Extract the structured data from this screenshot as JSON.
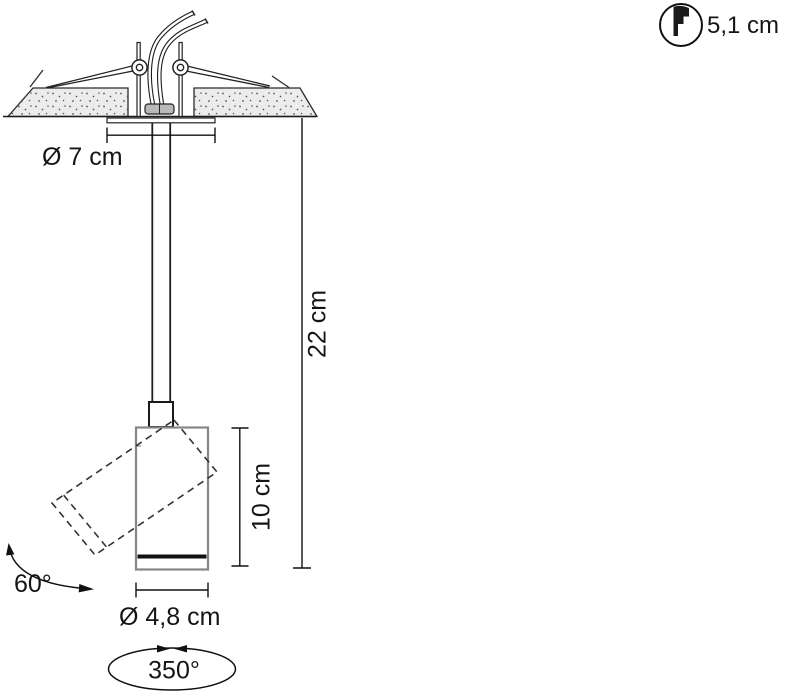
{
  "diagram": {
    "subject": "Recessed ceiling spotlight - installation drawing, side view",
    "labels": {
      "cutout_diameter": "Ø 7 cm",
      "overall_height": "22 cm",
      "body_height": "10 cm",
      "body_diameter": "Ø 4,8 cm",
      "tilt_range": "60°",
      "rotation_range": "350°",
      "recess_depth": "5,1 cm"
    },
    "icons": {
      "recess_depth_icon": "circle-with-stepped-recess-profile"
    },
    "colors": {
      "line": "#1a1a1a",
      "body_outline": "#868686",
      "ceiling_fill": "#ececec",
      "stipple_dots": "#555555",
      "background": "#ffffff"
    }
  }
}
